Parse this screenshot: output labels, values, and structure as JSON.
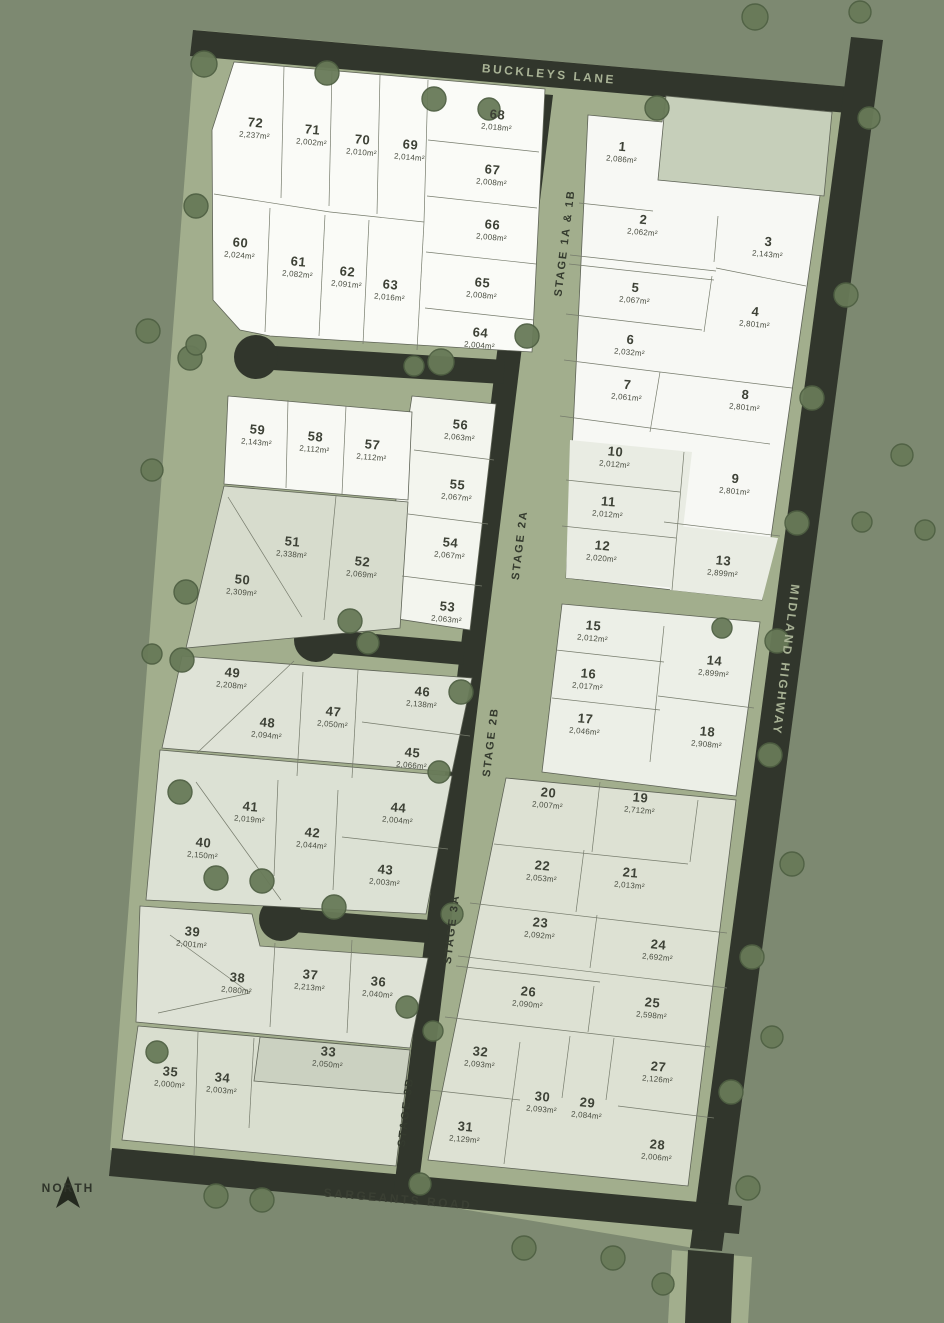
{
  "map": {
    "type": "land-subdivision-masterplan",
    "north_label": "NORTH"
  },
  "colors": {
    "background": "#7d8971",
    "verge_green": "#a2ae8d",
    "road_dark": "#31362c",
    "lot_white": "#fafbf7",
    "lot_pale_grey": "#e9ece3",
    "lot_green_grey": "#dde1d3",
    "lot_dark_strip": "#cbd1c1",
    "reserve_green": "#c6cfba",
    "tree_green": "#687a58",
    "text_dark": "#3d4136",
    "road_text": "#a8b295"
  },
  "road_labels": [
    {
      "label": "BUCKLEYS LANE",
      "x": 549,
      "y": 74,
      "style": "on-road"
    },
    {
      "label": "MIDLAND HIGHWAY",
      "x": 786,
      "y": 660,
      "style": "on-road highway"
    },
    {
      "label": "SARGEANTS ROAD",
      "x": 398,
      "y": 1199,
      "style": "on-verge"
    }
  ],
  "stage_labels": [
    {
      "label": "STAGE 1A & 1B",
      "x": 565,
      "y": 243
    },
    {
      "label": "STAGE 2A",
      "x": 520,
      "y": 545
    },
    {
      "label": "STAGE 2B",
      "x": 491,
      "y": 742
    },
    {
      "label": "STAGE 3A",
      "x": 452,
      "y": 929
    },
    {
      "label": "STAGE 3B",
      "x": 406,
      "y": 1112
    }
  ],
  "lots": [
    {
      "n": "1",
      "area": "2,086m²",
      "x": 622,
      "y": 152
    },
    {
      "n": "2",
      "area": "2,062m²",
      "x": 643,
      "y": 225
    },
    {
      "n": "3",
      "area": "2,143m²",
      "x": 768,
      "y": 247
    },
    {
      "n": "4",
      "area": "2,801m²",
      "x": 755,
      "y": 317
    },
    {
      "n": "5",
      "area": "2,067m²",
      "x": 635,
      "y": 293
    },
    {
      "n": "6",
      "area": "2,032m²",
      "x": 630,
      "y": 345
    },
    {
      "n": "7",
      "area": "2,061m²",
      "x": 627,
      "y": 390
    },
    {
      "n": "8",
      "area": "2,801m²",
      "x": 745,
      "y": 400
    },
    {
      "n": "9",
      "area": "2,801m²",
      "x": 735,
      "y": 484
    },
    {
      "n": "10",
      "area": "2,012m²",
      "x": 615,
      "y": 457
    },
    {
      "n": "11",
      "area": "2,012m²",
      "x": 608,
      "y": 507
    },
    {
      "n": "12",
      "area": "2,020m²",
      "x": 602,
      "y": 551
    },
    {
      "n": "13",
      "area": "2,899m²",
      "x": 723,
      "y": 566
    },
    {
      "n": "14",
      "area": "2,899m²",
      "x": 714,
      "y": 666
    },
    {
      "n": "15",
      "area": "2,012m²",
      "x": 593,
      "y": 631
    },
    {
      "n": "16",
      "area": "2,017m²",
      "x": 588,
      "y": 679
    },
    {
      "n": "17",
      "area": "2,046m²",
      "x": 585,
      "y": 724
    },
    {
      "n": "18",
      "area": "2,908m²",
      "x": 707,
      "y": 737
    },
    {
      "n": "19",
      "area": "2,712m²",
      "x": 640,
      "y": 803
    },
    {
      "n": "20",
      "area": "2,007m²",
      "x": 548,
      "y": 798
    },
    {
      "n": "21",
      "area": "2,013m²",
      "x": 630,
      "y": 878
    },
    {
      "n": "22",
      "area": "2,053m²",
      "x": 542,
      "y": 871
    },
    {
      "n": "23",
      "area": "2,092m²",
      "x": 540,
      "y": 928
    },
    {
      "n": "24",
      "area": "2,692m²",
      "x": 658,
      "y": 950
    },
    {
      "n": "25",
      "area": "2,598m²",
      "x": 652,
      "y": 1008
    },
    {
      "n": "26",
      "area": "2,090m²",
      "x": 528,
      "y": 997
    },
    {
      "n": "27",
      "area": "2,126m²",
      "x": 658,
      "y": 1072
    },
    {
      "n": "28",
      "area": "2,006m²",
      "x": 657,
      "y": 1150
    },
    {
      "n": "29",
      "area": "2,084m²",
      "x": 587,
      "y": 1108
    },
    {
      "n": "30",
      "area": "2,093m²",
      "x": 542,
      "y": 1102
    },
    {
      "n": "31",
      "area": "2,129m²",
      "x": 465,
      "y": 1132
    },
    {
      "n": "32",
      "area": "2,093m²",
      "x": 480,
      "y": 1057
    },
    {
      "n": "33",
      "area": "2,050m²",
      "x": 328,
      "y": 1057
    },
    {
      "n": "34",
      "area": "2,003m²",
      "x": 222,
      "y": 1083
    },
    {
      "n": "35",
      "area": "2,000m²",
      "x": 170,
      "y": 1077
    },
    {
      "n": "36",
      "area": "2,040m²",
      "x": 378,
      "y": 987
    },
    {
      "n": "37",
      "area": "2,213m²",
      "x": 310,
      "y": 980
    },
    {
      "n": "38",
      "area": "2,080m²",
      "x": 237,
      "y": 983
    },
    {
      "n": "39",
      "area": "2,001m²",
      "x": 192,
      "y": 937
    },
    {
      "n": "40",
      "area": "2,150m²",
      "x": 203,
      "y": 848
    },
    {
      "n": "41",
      "area": "2,019m²",
      "x": 250,
      "y": 812
    },
    {
      "n": "42",
      "area": "2,044m²",
      "x": 312,
      "y": 838
    },
    {
      "n": "43",
      "area": "2,003m²",
      "x": 385,
      "y": 875
    },
    {
      "n": "44",
      "area": "2,004m²",
      "x": 398,
      "y": 813
    },
    {
      "n": "45",
      "area": "2,066m²",
      "x": 412,
      "y": 758
    },
    {
      "n": "46",
      "area": "2,138m²",
      "x": 422,
      "y": 697
    },
    {
      "n": "47",
      "area": "2,050m²",
      "x": 333,
      "y": 717
    },
    {
      "n": "48",
      "area": "2,094m²",
      "x": 267,
      "y": 728
    },
    {
      "n": "49",
      "area": "2,208m²",
      "x": 232,
      "y": 678
    },
    {
      "n": "50",
      "area": "2,309m²",
      "x": 242,
      "y": 585
    },
    {
      "n": "51",
      "area": "2,338m²",
      "x": 292,
      "y": 547
    },
    {
      "n": "52",
      "area": "2,069m²",
      "x": 362,
      "y": 567
    },
    {
      "n": "53",
      "area": "2,063m²",
      "x": 447,
      "y": 612
    },
    {
      "n": "54",
      "area": "2,067m²",
      "x": 450,
      "y": 548
    },
    {
      "n": "55",
      "area": "2,067m²",
      "x": 457,
      "y": 490
    },
    {
      "n": "56",
      "area": "2,063m²",
      "x": 460,
      "y": 430
    },
    {
      "n": "57",
      "area": "2,112m²",
      "x": 372,
      "y": 450
    },
    {
      "n": "58",
      "area": "2,112m²",
      "x": 315,
      "y": 442
    },
    {
      "n": "59",
      "area": "2,143m²",
      "x": 257,
      "y": 435
    },
    {
      "n": "60",
      "area": "2,024m²",
      "x": 240,
      "y": 248
    },
    {
      "n": "61",
      "area": "2,082m²",
      "x": 298,
      "y": 267
    },
    {
      "n": "62",
      "area": "2,091m²",
      "x": 347,
      "y": 277
    },
    {
      "n": "63",
      "area": "2,016m²",
      "x": 390,
      "y": 290
    },
    {
      "n": "64",
      "area": "2,004m²",
      "x": 480,
      "y": 338
    },
    {
      "n": "65",
      "area": "2,008m²",
      "x": 482,
      "y": 288
    },
    {
      "n": "66",
      "area": "2,008m²",
      "x": 492,
      "y": 230
    },
    {
      "n": "67",
      "area": "2,008m²",
      "x": 492,
      "y": 175
    },
    {
      "n": "68",
      "area": "2,018m²",
      "x": 497,
      "y": 120
    },
    {
      "n": "69",
      "area": "2,014m²",
      "x": 410,
      "y": 150
    },
    {
      "n": "70",
      "area": "2,010m²",
      "x": 362,
      "y": 145
    },
    {
      "n": "71",
      "area": "2,002m²",
      "x": 312,
      "y": 135
    },
    {
      "n": "72",
      "area": "2,237m²",
      "x": 255,
      "y": 128
    }
  ],
  "trees": [
    [
      204,
      64,
      13
    ],
    [
      327,
      73,
      12
    ],
    [
      434,
      99,
      12
    ],
    [
      489,
      109,
      11
    ],
    [
      657,
      108,
      12
    ],
    [
      755,
      17,
      13
    ],
    [
      860,
      12,
      11
    ],
    [
      869,
      118,
      11
    ],
    [
      846,
      295,
      12
    ],
    [
      812,
      398,
      12
    ],
    [
      862,
      522,
      10
    ],
    [
      797,
      523,
      12
    ],
    [
      777,
      641,
      12
    ],
    [
      722,
      628,
      10
    ],
    [
      770,
      755,
      12
    ],
    [
      792,
      864,
      12
    ],
    [
      752,
      957,
      12
    ],
    [
      772,
      1037,
      11
    ],
    [
      731,
      1092,
      12
    ],
    [
      748,
      1188,
      12
    ],
    [
      902,
      455,
      11
    ],
    [
      925,
      530,
      10
    ],
    [
      196,
      206,
      12
    ],
    [
      148,
      331,
      12
    ],
    [
      190,
      358,
      12
    ],
    [
      152,
      470,
      11
    ],
    [
      186,
      592,
      12
    ],
    [
      182,
      660,
      12
    ],
    [
      152,
      654,
      10
    ],
    [
      180,
      792,
      12
    ],
    [
      216,
      878,
      12
    ],
    [
      262,
      881,
      12
    ],
    [
      157,
      1052,
      11
    ],
    [
      216,
      1196,
      12
    ],
    [
      262,
      1200,
      12
    ],
    [
      196,
      345,
      10
    ],
    [
      527,
      336,
      12
    ],
    [
      441,
      362,
      13
    ],
    [
      414,
      366,
      10
    ],
    [
      350,
      621,
      12
    ],
    [
      368,
      643,
      11
    ],
    [
      461,
      692,
      12
    ],
    [
      439,
      772,
      11
    ],
    [
      334,
      907,
      12
    ],
    [
      452,
      914,
      11
    ],
    [
      407,
      1007,
      11
    ],
    [
      433,
      1031,
      10
    ],
    [
      420,
      1184,
      11
    ],
    [
      524,
      1248,
      12
    ],
    [
      613,
      1258,
      12
    ],
    [
      663,
      1284,
      11
    ]
  ]
}
